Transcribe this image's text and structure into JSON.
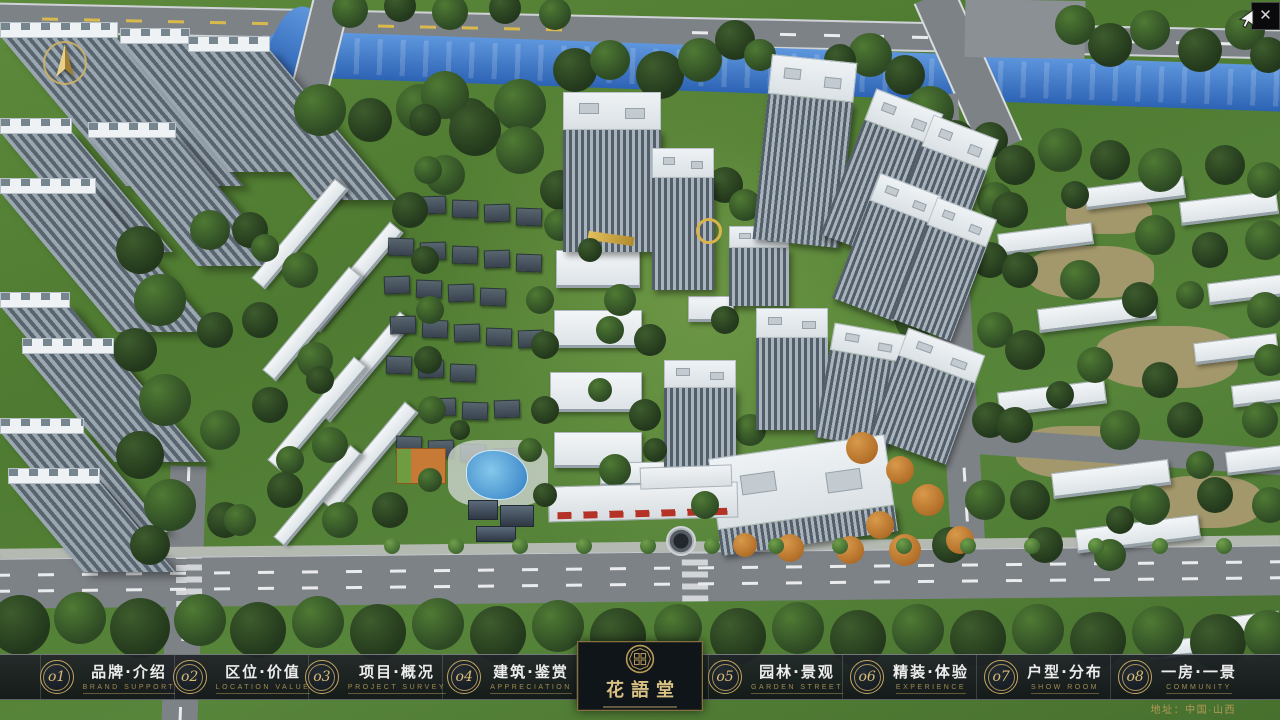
{
  "window": {
    "close_glyph": "✕"
  },
  "logo": {
    "title": "花語堂"
  },
  "nav": {
    "items": [
      {
        "num": "o1",
        "title": "品牌·介绍",
        "subtitle": "BRAND SUPPORT"
      },
      {
        "num": "o2",
        "title": "区位·价值",
        "subtitle": "LOCATION VALUE"
      },
      {
        "num": "o3",
        "title": "项目·概况",
        "subtitle": "PROJECT SURVEY"
      },
      {
        "num": "o4",
        "title": "建筑·鉴赏",
        "subtitle": "APPRECIATION"
      },
      {
        "num": "o5",
        "title": "园林·景观",
        "subtitle": "GARDEN STREET"
      },
      {
        "num": "o6",
        "title": "精装·体验",
        "subtitle": "EXPERIENCE"
      },
      {
        "num": "o7",
        "title": "户型·分布",
        "subtitle": "SHOW ROOM"
      },
      {
        "num": "o8",
        "title": "一房·一景",
        "subtitle": "COMMUNITY"
      }
    ]
  },
  "footer": {
    "address": "地址：中国·山西"
  },
  "colors": {
    "gold": "#c3a75f",
    "bar_bg": "#14181c",
    "river_blue": "#3a77c8",
    "grass_green": "#57853a"
  }
}
